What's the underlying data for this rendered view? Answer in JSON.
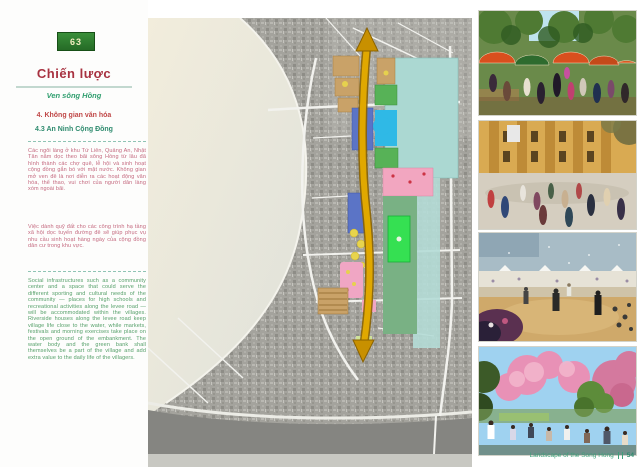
{
  "document": {
    "badge": "63",
    "title": "Chiến lược",
    "subtitle": "Ven sông Hồng",
    "heading_primary": "4. Không gian văn hóa",
    "heading_secondary": "4.3 An Ninh Cộng Đồng",
    "paragraph_vi_1": "Các ngôi làng ở khu Tứ Liên, Quảng An, Nhật Tân nằm dọc theo bãi sông Hồng từ lâu đã hình thành các chợ quê, lễ hội và sinh hoạt cộng đồng gắn bó với mặt nước. Không gian mở ven đê là nơi diễn ra các hoạt động văn hóa, thể thao, vui chơi của người dân làng xóm ngoài bãi.",
    "paragraph_vi_2": "Việc dành quỹ đất cho các công trình hạ tầng xã hội dọc tuyến đường đê sẽ giúp phục vụ nhu cầu sinh hoạt hàng ngày của cộng đồng dân cư trong khu vực.",
    "paragraph_en": "Social infrastructures such as a community center and a space that could serve the different sporting and cultural needs of the community — places for high schools and recreational activities along the levee road — will be accommodated within the villages. Riverside houses along the levee road keep village life close to the water, while markets, festivals and morning exercises take place on the open ground of the embankment. The water body and the green bank shall themselves be a part of the village and add extra value to the daily life of the villagers.",
    "footer_caption": "Landscape of the Song Hong",
    "page_number": "54"
  },
  "colors": {
    "badge_green": "#2f7d32",
    "title_red": "#a83240",
    "heading_red": "#c04848",
    "heading_green": "#2e8b6e",
    "body_pink": "#c4697f",
    "body_green": "#56a06a",
    "corridor_amber": "#e0a800",
    "zone_teal": "#abd8d2",
    "zone_green": "#57b257",
    "zone_bright_green": "#35e052",
    "zone_blue": "#5b74c6",
    "zone_cyan": "#2fb9e6",
    "zone_pink": "#f2a6c0",
    "zone_tan": "#c9a268",
    "footer_green": "#3fa07a"
  }
}
